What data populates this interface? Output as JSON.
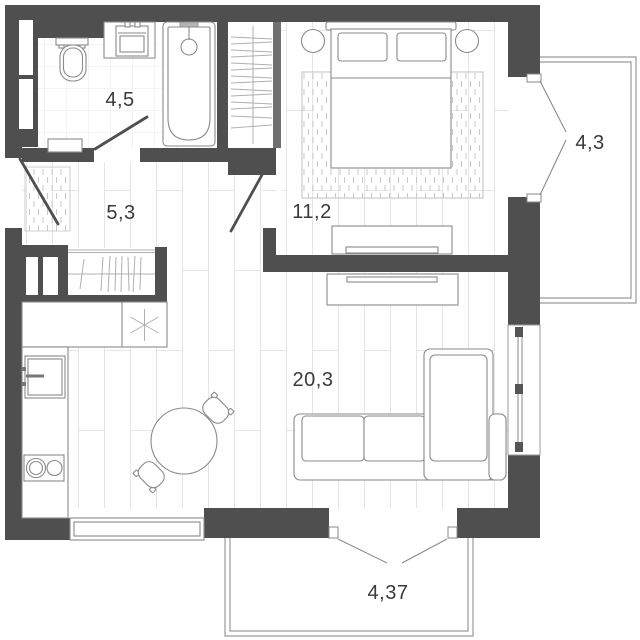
{
  "plan": {
    "type": "apartment-floor-plan",
    "rooms": [
      {
        "name": "bathroom",
        "area": "4,5"
      },
      {
        "name": "hallway",
        "area": "5,3"
      },
      {
        "name": "bedroom",
        "area": "11,2"
      },
      {
        "name": "balcony-right",
        "area": "4,3"
      },
      {
        "name": "kitchen-living-room",
        "area": "20,3"
      },
      {
        "name": "balcony-bottom",
        "area": "4,37"
      }
    ],
    "colors": {
      "wall": "#4f4f4f",
      "fixture_line": "#8a8a8a",
      "floor_line": "#e5e5e5",
      "rug_line": "#c8c8c8",
      "label_text": "#3a3a3a",
      "door_leaf": "#4f4f4f",
      "swing_line": "#8a8a8a",
      "balcony_line": "#9a9a9a"
    }
  }
}
